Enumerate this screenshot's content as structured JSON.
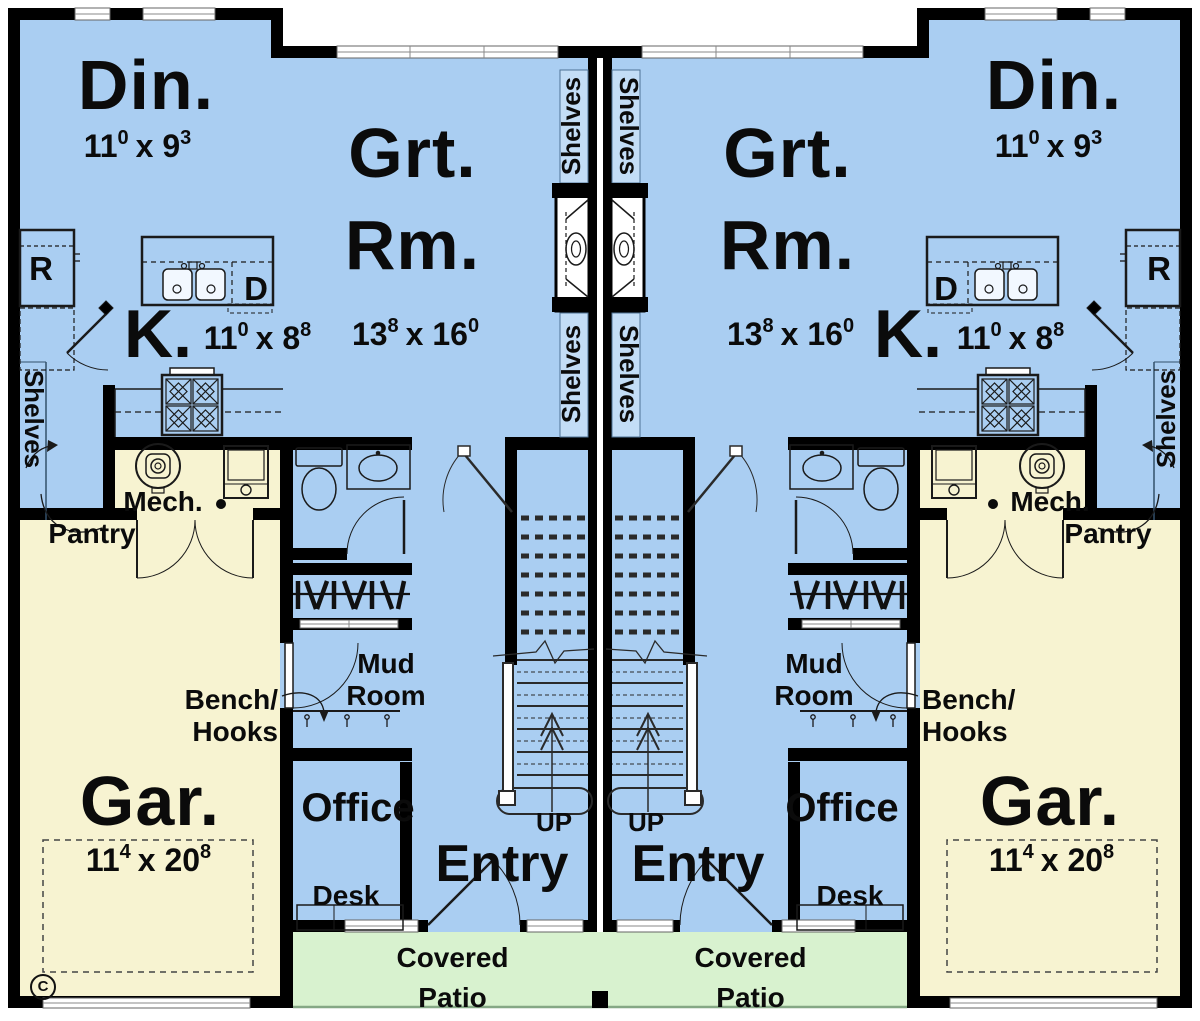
{
  "colors": {
    "floor": "#aacef2",
    "garage_floor": "#f7f3d1",
    "patio_floor": "#d8f2cf",
    "shelf_band": "#c3ddf6",
    "wall": "#000000"
  },
  "rooms": {
    "dining": {
      "label": "Din."
    },
    "great": {
      "line1": "Grt.",
      "line2": "Rm."
    },
    "kitchen": {
      "label": "K."
    },
    "garage": {
      "label": "Gar."
    },
    "mech": {
      "label": "Mech."
    },
    "pantry": {
      "label": "Pantry"
    },
    "mud": {
      "line1": "Mud",
      "line2": "Room"
    },
    "office": {
      "label": "Office"
    },
    "entry": {
      "label": "Entry"
    },
    "patio": {
      "line1": "Covered",
      "line2": "Patio"
    }
  },
  "annotations": {
    "shelves": "Shelves",
    "bench1": "Bench/",
    "bench2": "Hooks",
    "desk": "Desk",
    "up": "UP",
    "refrigerator": "R",
    "dishwasher": "D",
    "copyright": "C"
  },
  "dims": {
    "dining": {
      "a": "11",
      "asup": "0",
      "b": "x 9",
      "bsup": "3"
    },
    "great": {
      "a": "13",
      "asup": "8",
      "b": "x 16",
      "bsup": "0"
    },
    "kitchen": {
      "a": "11",
      "asup": "0",
      "b": "x 8",
      "bsup": "8"
    },
    "garage": {
      "a": "11",
      "asup": "4",
      "b": "x 20",
      "bsup": "8"
    }
  }
}
